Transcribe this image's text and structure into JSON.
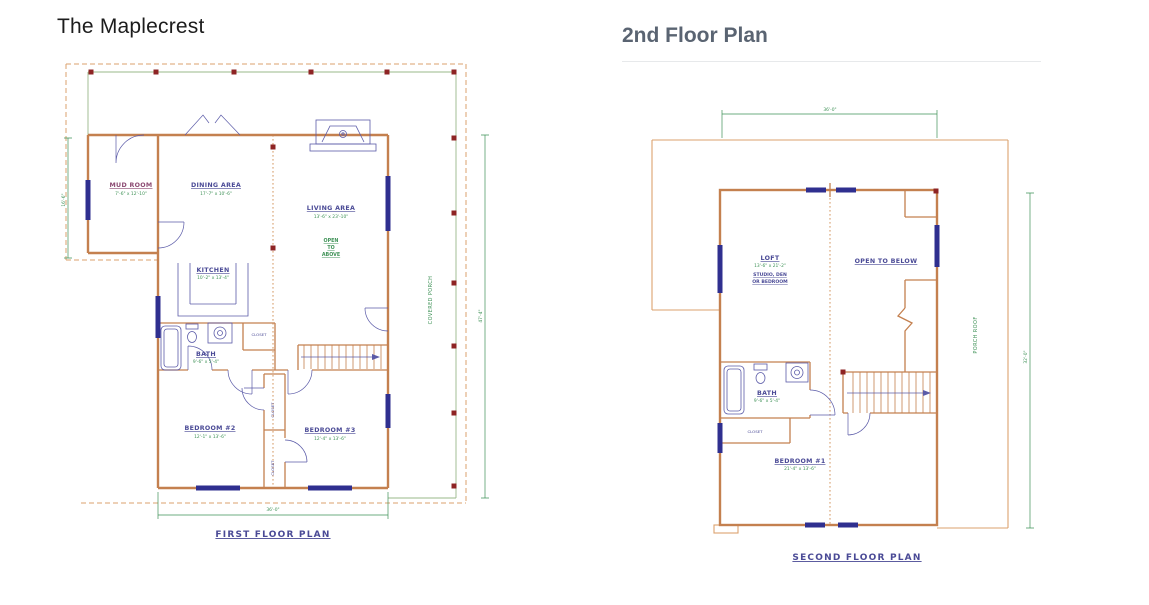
{
  "first_floor": {
    "title": "The Maplecrest",
    "plan_label": "FIRST FLOOR PLAN",
    "rooms": {
      "mud_room": {
        "name": "MUD ROOM",
        "dims": "7'-6\" x 12'-10\""
      },
      "dining": {
        "name": "DINING AREA",
        "dims": "17'-7\" x 10'-6\""
      },
      "living": {
        "name": "LIVING AREA",
        "dims": "13'-6\" x 23'-10\"",
        "note_line1": "OPEN",
        "note_line2": "TO",
        "note_line3": "ABOVE"
      },
      "kitchen": {
        "name": "KITCHEN",
        "dims": "10'-2\" x 13'-4\""
      },
      "bath": {
        "name": "BATH",
        "dims": "9'-6\" x 5'-4\""
      },
      "closet": {
        "name": "CLOSET"
      },
      "bedroom2": {
        "name": "BEDROOM #2",
        "dims": "12'-1\" x 13'-6\""
      },
      "bedroom3": {
        "name": "BEDROOM #3",
        "dims": "12'-4\" x 13'-6\""
      },
      "covered_porch": {
        "name": "COVERED PORCH"
      }
    },
    "dimensions": {
      "left": "16'-6\"",
      "bottom": "36'-0\"",
      "right": "47'-4\""
    }
  },
  "second_floor": {
    "title": "2nd Floor Plan",
    "plan_label": "SECOND FLOOR PLAN",
    "rooms": {
      "loft": {
        "name": "LOFT",
        "dims": "13'-6\" x 21'-2\"",
        "note_line1": "STUDIO, DEN",
        "note_line2": "OR BEDROOM"
      },
      "open_below": {
        "name": "OPEN TO BELOW"
      },
      "bath": {
        "name": "BATH",
        "dims": "9'-6\" x 5'-4\""
      },
      "closet": {
        "name": "CLOSET"
      },
      "bedroom1": {
        "name": "BEDROOM #1",
        "dims": "21'-4\" x 13'-6\""
      },
      "porch_roof": {
        "name": "PORCH ROOF"
      }
    },
    "dimensions": {
      "top": "36'-0\"",
      "right": "32'-0\""
    }
  },
  "colors": {
    "wall": "#c4804f",
    "post": "#8e2424",
    "dash_orange": "#dba26e",
    "dot_orange": "#cf8a4e",
    "porch_line": "#9ab88a",
    "green": "#3f9257",
    "navy_line": "#5b5ba8",
    "window": "#2f2f8f",
    "label_navy": "#4a4a96",
    "label_maroon": "#8c4a72",
    "title_dark": "#1c1c1c",
    "subtitle_gray": "#5a6472",
    "divider": "#e7e9eb"
  }
}
